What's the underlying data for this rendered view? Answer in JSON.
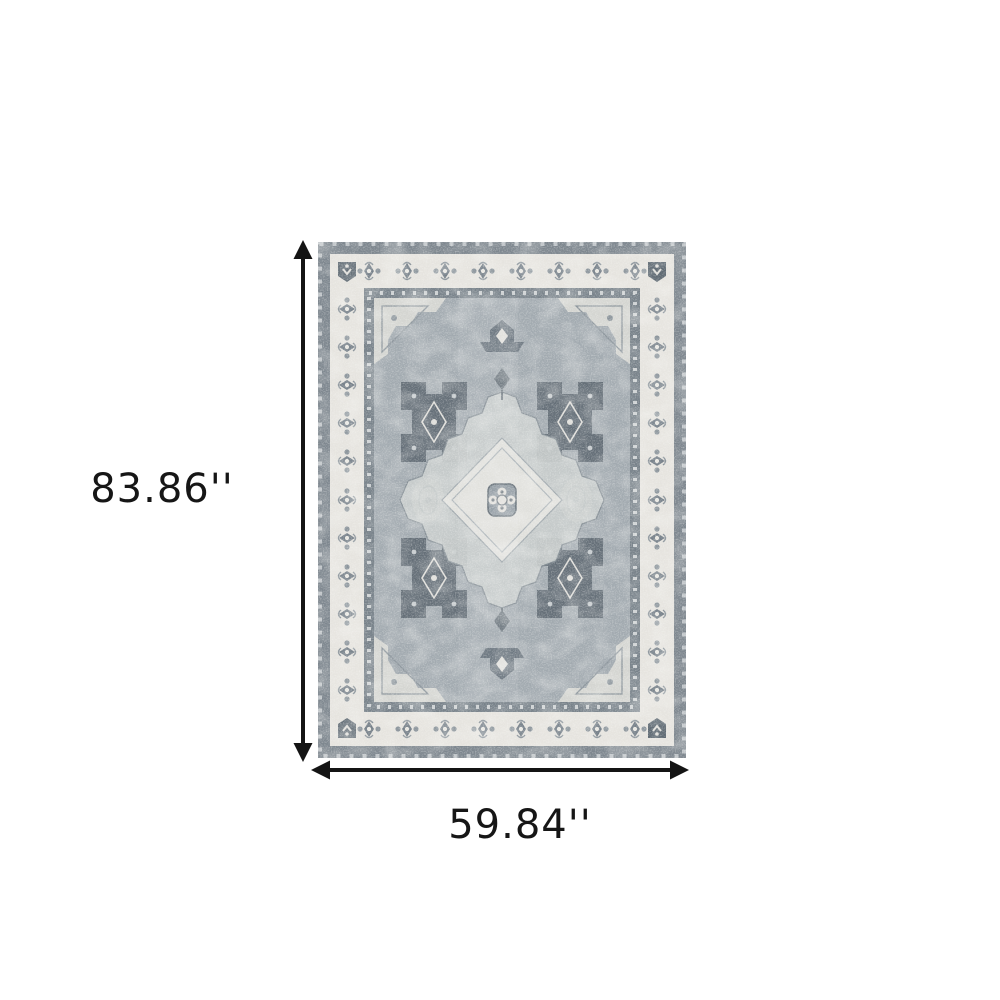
{
  "figure": {
    "description": "Distressed grey and ivory traditional oriental medallion area rug shown with dimension arrows",
    "height_label": "83.86''",
    "width_label": "59.84''"
  },
  "colors": {
    "background": "#ffffff",
    "arrow": "#141414",
    "label_text": "#161616",
    "rug_outer_band": "#7e878f",
    "rug_ivory_border": "#e6e4df",
    "rug_guard_stripe": "#78828a",
    "rug_field": "#a2aab0",
    "rug_dark_motif": "#5a656f",
    "rug_light_motif": "#dcdbd7"
  }
}
